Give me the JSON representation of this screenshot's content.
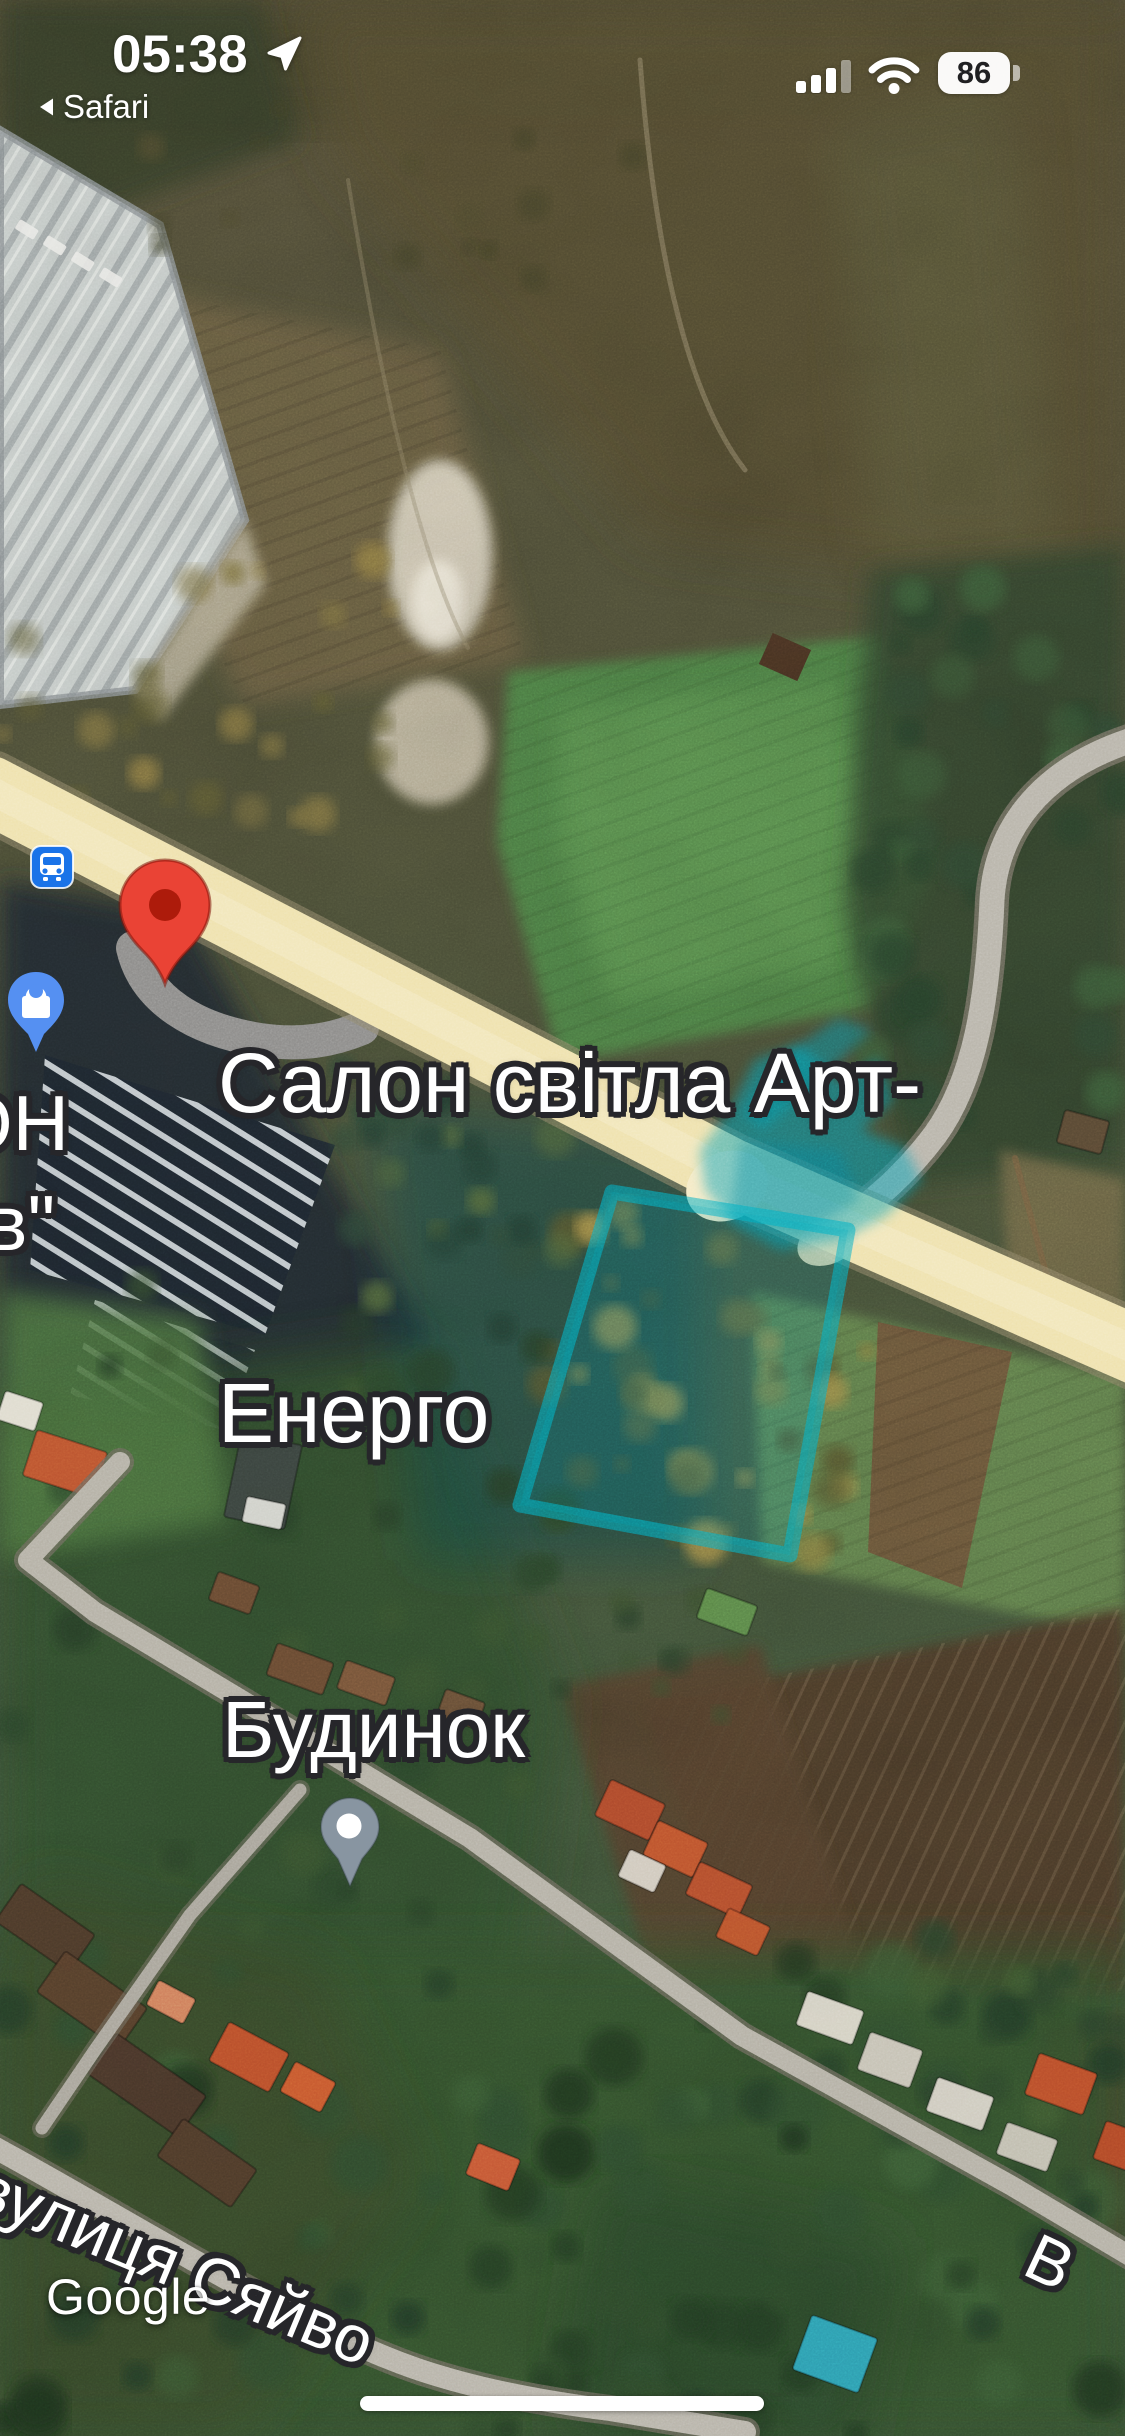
{
  "status_bar": {
    "time": "05:38",
    "back_app": "Safari",
    "battery_percent": "86"
  },
  "map": {
    "poi_label": {
      "line1": "Салон світла Арт-",
      "line2": "Енерго"
    },
    "cutoff_label": {
      "line1": "ОН",
      "line2": "в\""
    },
    "house_label": "Будинок",
    "street_label": "вулиця Сяйво",
    "street_label_cutoff": "В",
    "watermark": "Google",
    "colors": {
      "pin_red": "#EA4335",
      "pin_red_inner": "#AD1B0B",
      "transit_blue": "#1A73E8",
      "shopping_pin_blue": "#5590F2",
      "dot_marker_gray": "#8895A1",
      "road_yellow": "#EFE2AE",
      "selection_teal": "#00A0B4"
    }
  }
}
